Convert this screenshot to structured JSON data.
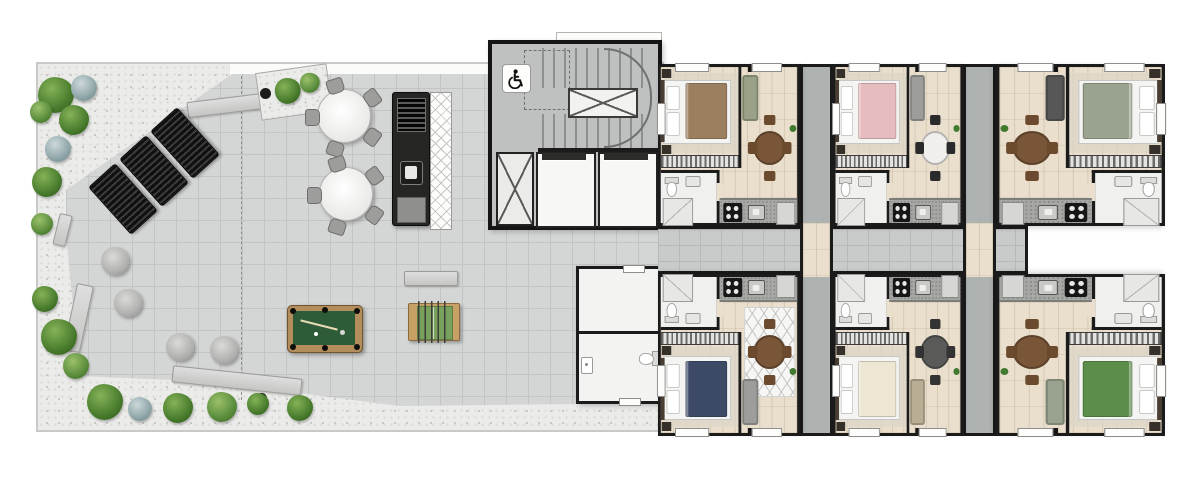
{
  "document": {
    "kind": "architectural floor plan",
    "view": "top-down furnished color render",
    "sections": [
      "rooftop terrace",
      "circulation core",
      "apartment wing"
    ]
  },
  "palette": {
    "background": "#ffffff",
    "walls": "#1b1b1b",
    "terrace_tiles": "#d4d6d5",
    "gravel": "#ebebe9",
    "wood_floor": "#e9dfcc",
    "corridor_tiles": "#c9cbca",
    "core_floor": "#bfc1c0",
    "pool_felt": "#2e5c38",
    "shrub_green": "#4e7d2e"
  },
  "terrace": {
    "floor": "light gray pavers",
    "edge": "gravel strip with shrubs and planters",
    "amenities": [
      {
        "name": "sun lounger",
        "count": 3
      },
      {
        "name": "round table with chairs",
        "count": 2,
        "seats_each": 5
      },
      {
        "name": "bean bag pouf",
        "count": 4
      },
      {
        "name": "pool table",
        "count": 1
      },
      {
        "name": "foosball table",
        "count": 1
      },
      {
        "name": "grill counter",
        "count": 1,
        "features": [
          "barbecue grill",
          "sink",
          "cabinet"
        ]
      },
      {
        "name": "pergola strip",
        "count": 1
      },
      {
        "name": "concrete bench",
        "count": 5
      },
      {
        "name": "shrub",
        "count": 18
      },
      {
        "name": "planter box",
        "count": 1
      }
    ]
  },
  "core": {
    "stairwell": {
      "flights": 2,
      "central_void": true
    },
    "accessibility_icon": "wheelchair",
    "elevators": {
      "count": 2
    },
    "service_shaft": {
      "count": 1
    },
    "support_rooms": [
      {
        "name": "storage room",
        "fixtures": []
      },
      {
        "name": "shared wc",
        "fixtures": [
          "wash basin",
          "toilet"
        ]
      }
    ]
  },
  "corridor": {
    "floor": "gray tile",
    "entry_vestibules": 2
  },
  "apartments": {
    "count": 6,
    "layout_rows": {
      "top": 3,
      "bottom": 3
    },
    "rooms_per_unit": [
      "bedroom",
      "closet",
      "bathroom",
      "kitchen",
      "living-dining"
    ],
    "units": [
      {
        "id": "unit-1",
        "row": "top",
        "position": 1,
        "mirror": "none",
        "bed_color": "#9c7f5f",
        "sofa_color": "#99a287",
        "table_color": "#7a5638",
        "chair_color": "#6b4a2e",
        "rug": "plain"
      },
      {
        "id": "unit-2",
        "row": "top",
        "position": 2,
        "mirror": "none",
        "bed_color": "#e7bcbe",
        "sofa_color": "#9d9d9b",
        "table_color": "#f0efec",
        "chair_color": "#2a2a2a",
        "rug": "plain"
      },
      {
        "id": "unit-3",
        "row": "top",
        "position": 3,
        "mirror": "x",
        "bed_color": "#9aa38f",
        "sofa_color": "#575757",
        "table_color": "#7a5638",
        "chair_color": "#6b4a2e",
        "rug": "plain"
      },
      {
        "id": "unit-4",
        "row": "bottom",
        "position": 1,
        "mirror": "y",
        "bed_color": "#3d4a66",
        "sofa_color": "#9d9d9b",
        "table_color": "#7a5638",
        "chair_color": "#6b4a2e",
        "rug": "geometric"
      },
      {
        "id": "unit-5",
        "row": "bottom",
        "position": 2,
        "mirror": "y",
        "bed_color": "#ece6d2",
        "sofa_color": "#b9ad93",
        "table_color": "#5a5a58",
        "chair_color": "#333333",
        "rug": "plain"
      },
      {
        "id": "unit-6",
        "row": "bottom",
        "position": 3,
        "mirror": "xy",
        "bed_color": "#5c8d4b",
        "sofa_color": "#9aa38f",
        "table_color": "#7a5638",
        "chair_color": "#6b4a2e",
        "rug": "plain"
      }
    ]
  }
}
